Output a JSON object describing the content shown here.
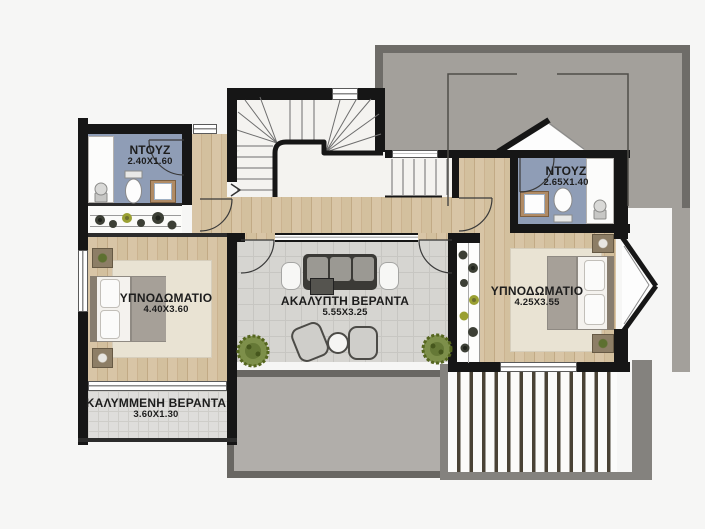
{
  "plan_title": "floor-plan",
  "rooms": {
    "shower_left": {
      "name": "ΝΤΟΥΖ",
      "dims": "2.40X1.60"
    },
    "shower_right": {
      "name": "ΝΤΟΥΖ",
      "dims": "2.65X1.40"
    },
    "bedroom_left": {
      "name": "ΥΠΝΟΔΩΜΑΤΙΟ",
      "dims": "4.40X3.60"
    },
    "bedroom_right": {
      "name": "ΥΠΝΟΔΩΜΑΤΙΟ",
      "dims": "4.25X3.55"
    },
    "veranda_open": {
      "name": "ΑΚΑΛΥΠΤΗ ΒΕΡΑΝΤΑ",
      "dims": "5.55X3.25"
    },
    "veranda_covered": {
      "name": "ΚΑΛΥΜΜΕΝΗ ΒΕΡΑΝΤΑ",
      "dims": "3.60X1.30"
    }
  },
  "colors": {
    "wall": "#161616",
    "wood_floor": "#d5c1a1",
    "tile_floor": "#d6d5d1",
    "bathroom_floor": "#8f9db6",
    "roof_terrace": "#a3a09b",
    "roof_border": "#6e6c68",
    "lower_terrace": "#b1aeaa",
    "plant_green": "#7d8f4a",
    "label_text": "#1d1d1d"
  },
  "icons": [
    "bed-icon",
    "toilet-icon",
    "sink-icon",
    "shower-head-icon",
    "sofa-icon",
    "armchair-icon",
    "coffee-table-icon",
    "round-table-icon",
    "plant-icon",
    "bush-icon",
    "door-swing-icon",
    "staircase-icon",
    "bay-window-icon",
    "pergola-icon"
  ]
}
